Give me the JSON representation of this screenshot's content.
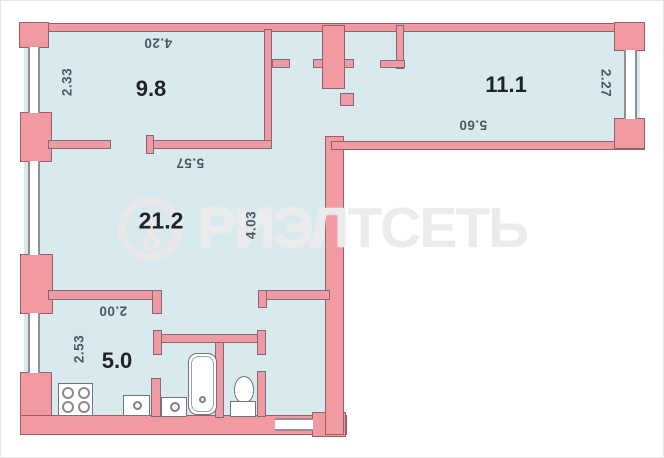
{
  "watermark": {
    "text": "РИЭЛТСЕТЬ",
    "logo": "ring-logo"
  },
  "rooms": {
    "bedroom": {
      "area": "9.8",
      "width": "4.20",
      "depth": "2.33"
    },
    "room2": {
      "area": "11.1",
      "width": "5.60",
      "depth": "2.27"
    },
    "living": {
      "area": "21.2",
      "width": "5.57",
      "depth": "4.03"
    },
    "kitchen": {
      "area": "5.0",
      "width": "2.00",
      "depth": "2.53"
    }
  },
  "fixtures": [
    "stove",
    "sink",
    "washing-machine",
    "bathtub",
    "toilet"
  ],
  "colors": {
    "wall": "#f19aa2",
    "wall_outline": "#96606b",
    "room_fill": "#d9eaee",
    "watermark": "#ebebeb",
    "dimension_text": "#4d5765",
    "area_label_text": "#1e222a"
  }
}
